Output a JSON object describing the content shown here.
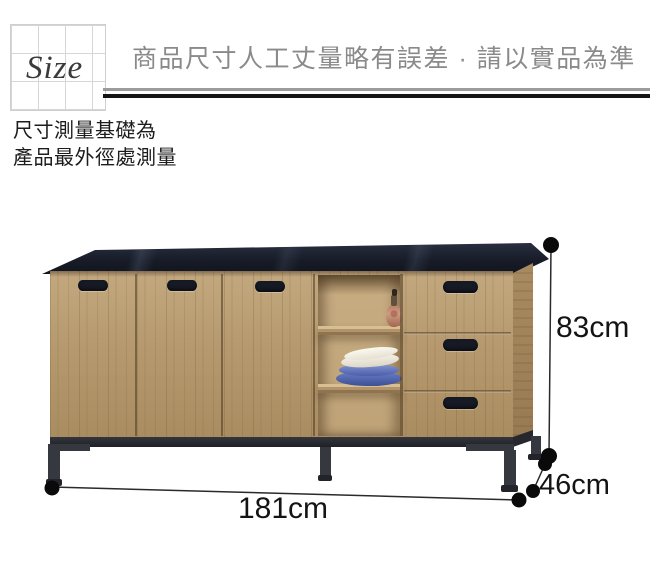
{
  "header": {
    "size_label": "Size",
    "disclaimer": "商品尺寸人工丈量略有誤差 · 請以實品為準"
  },
  "note": {
    "line1": "尺寸測量基礎為",
    "line2": "產品最外徑處測量"
  },
  "product": {
    "description": "wood sideboard with black stone top, 3 doors, open shelves with vase and plates, 3 drawers, black metal legs"
  },
  "dimensions": {
    "height": "83cm",
    "depth": "46cm",
    "width": "181cm"
  },
  "colors": {
    "wood": "#b6996e",
    "counter_top": "#171c28",
    "metal_legs": "#36383f",
    "disclaimer_gray": "#8a8a8a",
    "text_black": "#141414",
    "grid_line": "#d6d6d6"
  }
}
